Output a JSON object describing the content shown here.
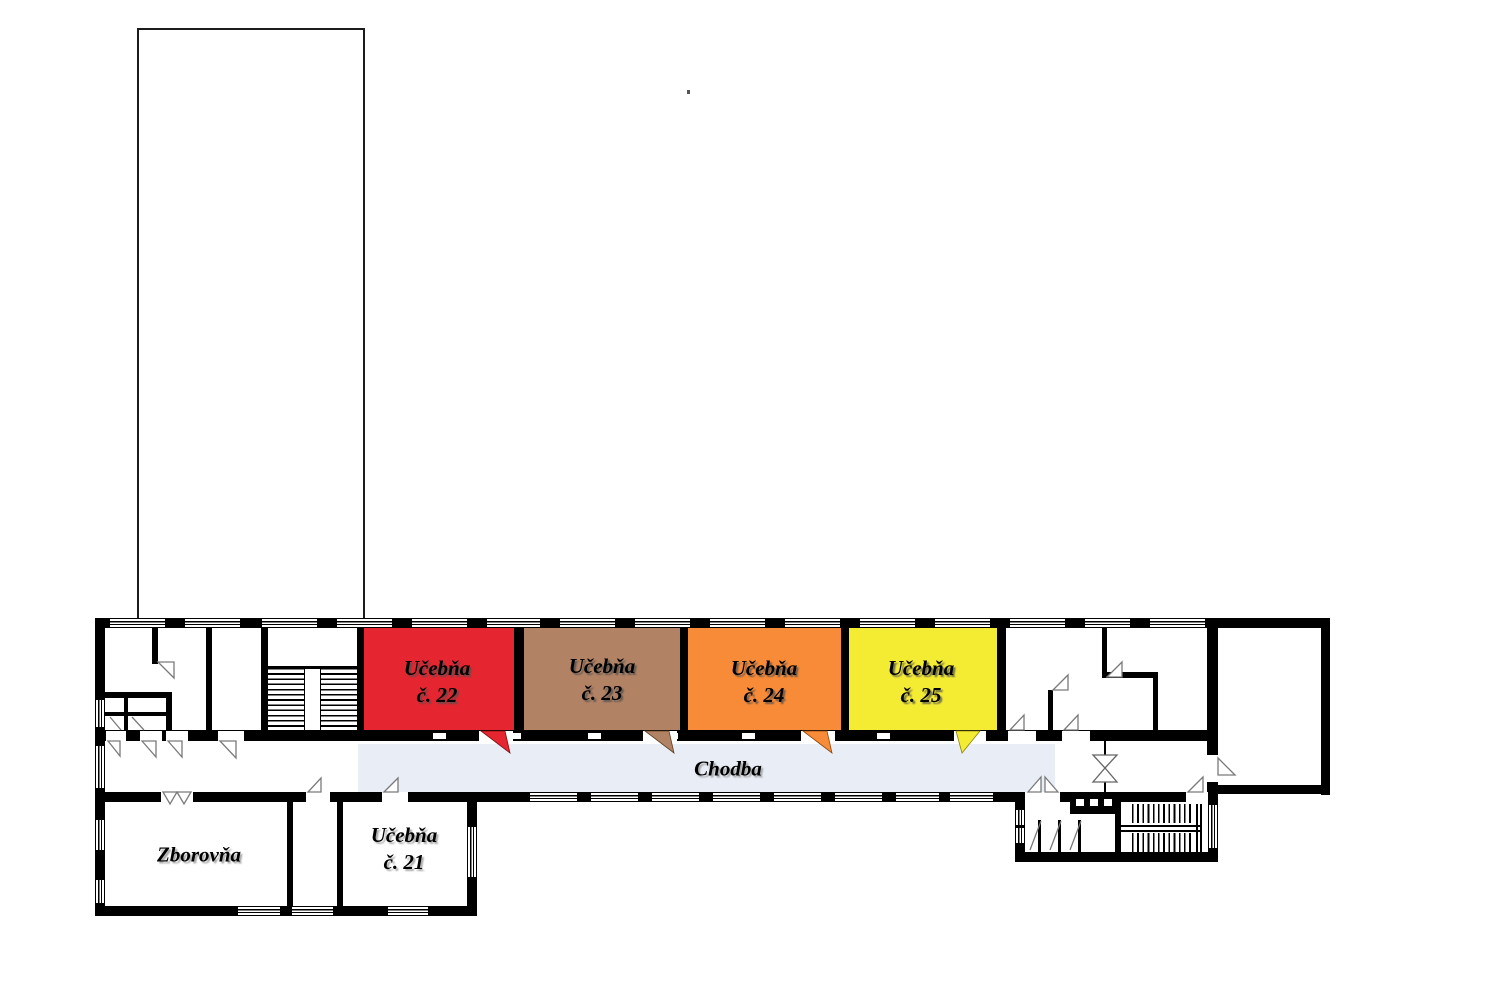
{
  "floor_plan": {
    "corridor": {
      "label": "Chodba",
      "color": "#e9edf6"
    },
    "rooms": {
      "r21": {
        "line1": "Učebňa",
        "line2": "č. 21",
        "color": "#ffffff"
      },
      "r22": {
        "line1": "Učebňa",
        "line2": "č. 22",
        "color": "#e52630"
      },
      "r23": {
        "line1": "Učebňa",
        "line2": "č. 23",
        "color": "#b28264"
      },
      "r24": {
        "line1": "Učebňa",
        "line2": "č. 24",
        "color": "#f88b37"
      },
      "r25": {
        "line1": "Učebňa",
        "line2": "č. 25",
        "color": "#f4ec33"
      },
      "zborovna": {
        "label": "Zborovňa",
        "color": "#ffffff"
      }
    },
    "colors": {
      "wall": "#000000",
      "background": "#ffffff",
      "swing": "#7a7a7a"
    }
  }
}
